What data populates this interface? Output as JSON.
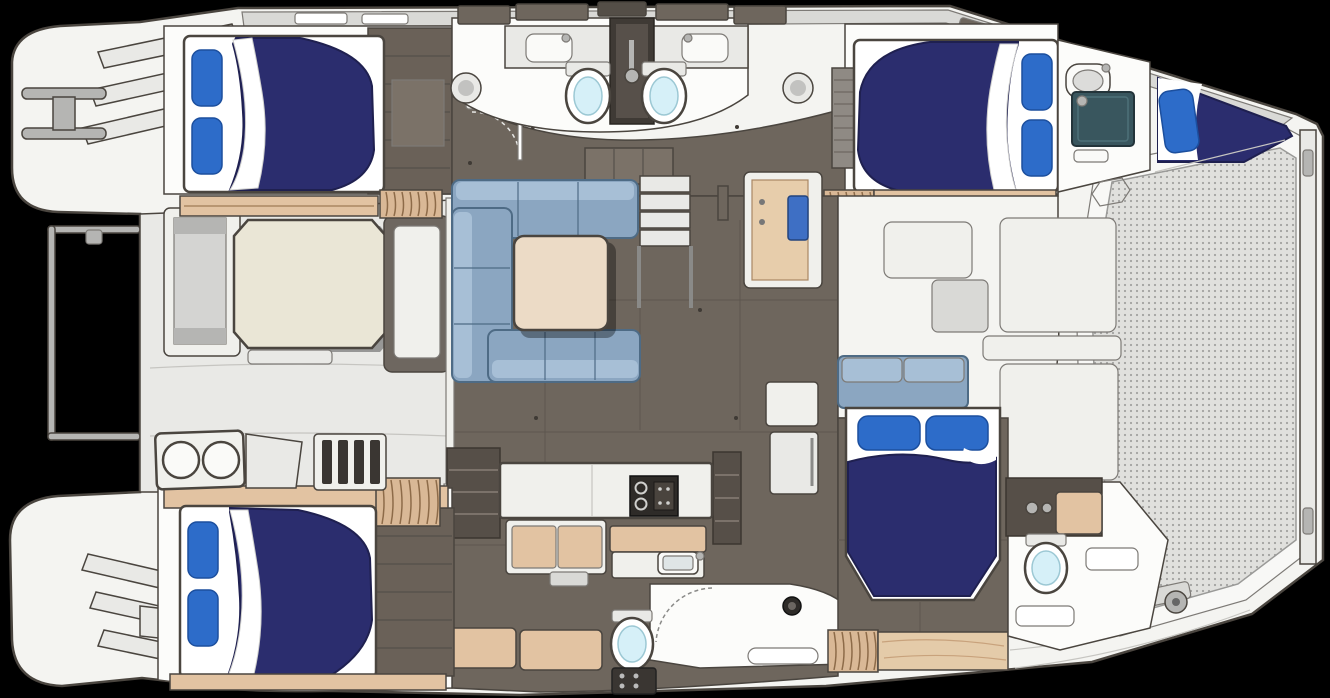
{
  "figure": {
    "kind": "floorplan",
    "alt_text": "Top-down interior floor plan of a sailing catamaran: four double cabins with navy bedding and blue pillows, two hulls with bathrooms and showers, central salon with U-shaped blue sofa and table, aft cockpit with octagonal table, galley with stove and sink, forepeak berth, and bow trampoline mesh on the right."
  },
  "palette": {
    "bg": "#000000",
    "line_dark": "#4a453f",
    "line_mid": "#7d7a76",
    "line_light": "#c6c5c1",
    "deck_white": "#f4f4f1",
    "deck_gray": "#d9d9d6",
    "deck_light": "#e9e9e6",
    "cabin_white": "#fcfcfa",
    "floor_taupe": "#6e665d",
    "floor_taupe_dark": "#544e47",
    "wood_dark": "#6a6158",
    "wood_tan": "#e2c3a2",
    "wood_light": "#e4cba9",
    "counter_white": "#f0f0ec",
    "fixture_white": "#fafaf8",
    "bed_navy": "#2b2d6e",
    "bed_navy_dark": "#1f2050",
    "pillow_blue": "#2d6cc9",
    "pillow_blue_dark": "#1c4f9e",
    "sofa_blue": "#8ba6c1",
    "sofa_blue_light": "#a7bfd6",
    "sofa_blue_dark": "#4e6b85",
    "table_beige": "#ecdbc6",
    "table_cream": "#eae6d6",
    "toilet_cyan": "#d6f0f8",
    "shower_teal": "#39565e",
    "appliance_dark": "#2e2b28",
    "appliance_mid": "#4a443e",
    "metal_gray": "#b5b5b3",
    "mesh_bg": "#e0e0dd",
    "mesh_dot": "#a2a2a0"
  },
  "components": {
    "double_berths": 4,
    "forepeak_berths": 1,
    "toilets": 4,
    "showers": 2,
    "sinks": 4,
    "salon_sofas": 1,
    "cockpit_tables": 1,
    "salon_tables": 1,
    "galley_stoves": 1,
    "cockpit_grills": 1,
    "trampolines": 1
  }
}
